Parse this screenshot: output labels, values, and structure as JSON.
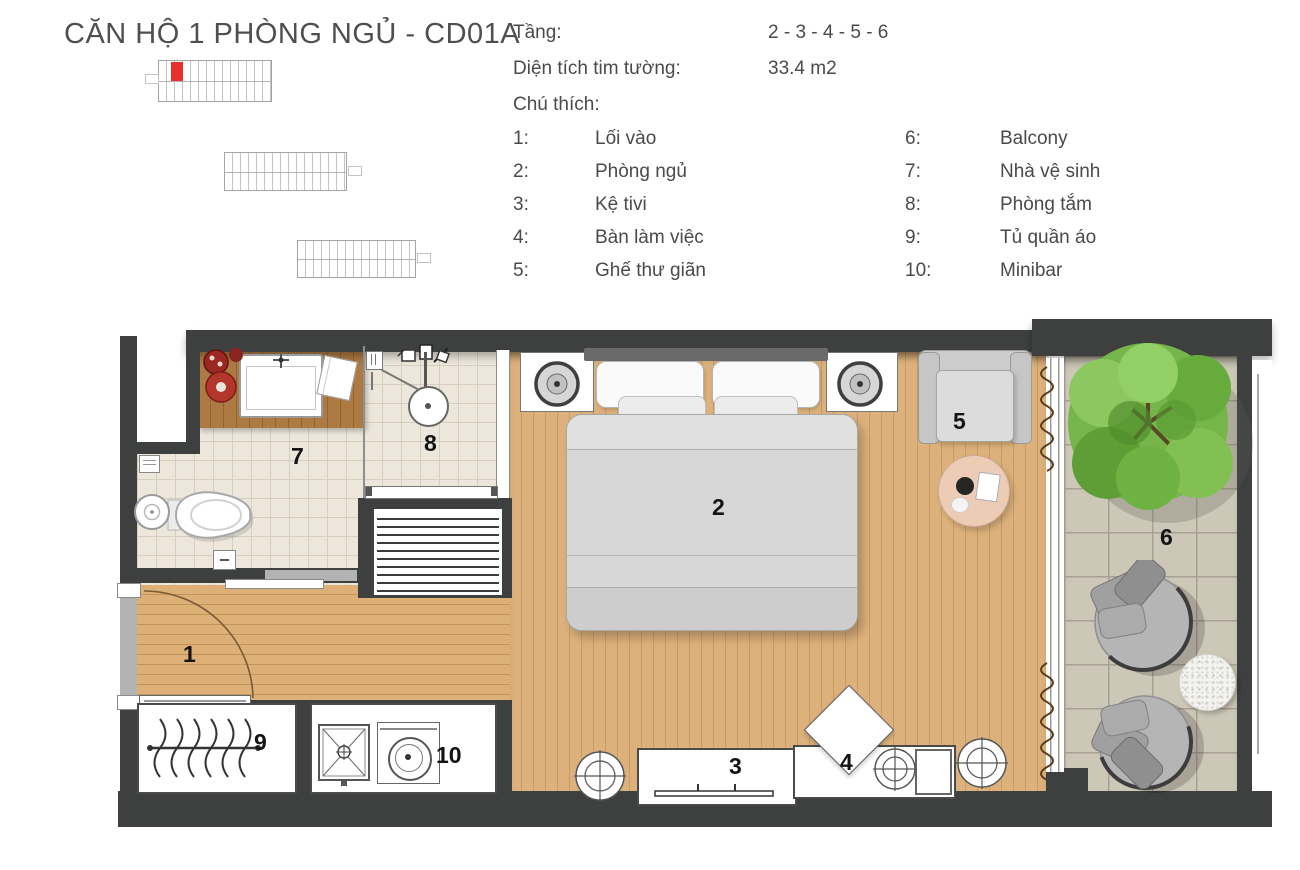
{
  "header": {
    "title": "CĂN HỘ 1 PHÒNG NGỦ - CD01A",
    "floor_label": "Tầng:",
    "floor_value": "2 - 3 - 4 - 5 - 6",
    "area_label": "Diện tích tim tường:",
    "area_value": "33.4 m2",
    "legend_title": "Chú thích:"
  },
  "legend": {
    "col1": [
      {
        "num": "1:",
        "label": "Lối vào"
      },
      {
        "num": "2:",
        "label": "Phòng ngủ"
      },
      {
        "num": "3:",
        "label": "Kệ tivi"
      },
      {
        "num": "4:",
        "label": "Bàn làm việc"
      },
      {
        "num": "5:",
        "label": "Ghế thư giãn"
      }
    ],
    "col2": [
      {
        "num": "6:",
        "label": "Balcony"
      },
      {
        "num": "7:",
        "label": "Nhà vệ sinh"
      },
      {
        "num": "8:",
        "label": "Phòng tắm"
      },
      {
        "num": "9:",
        "label": "Tủ quần áo"
      },
      {
        "num": "10:",
        "label": "Minibar"
      }
    ]
  },
  "plan_labels": {
    "entry": "1",
    "bedroom": "2",
    "tv_shelf": "3",
    "desk": "4",
    "relax_chair": "5",
    "balcony": "6",
    "wc": "7",
    "bathroom": "8",
    "wardrobe": "9",
    "minibar": "10"
  },
  "colors": {
    "wall": "#3e4040",
    "wood": "#d9ad74",
    "bath_tile": "#ede7db",
    "balcony_tile": "#cdc7b7",
    "highlight_unit": "#e8312a",
    "tree": "#76b549"
  }
}
